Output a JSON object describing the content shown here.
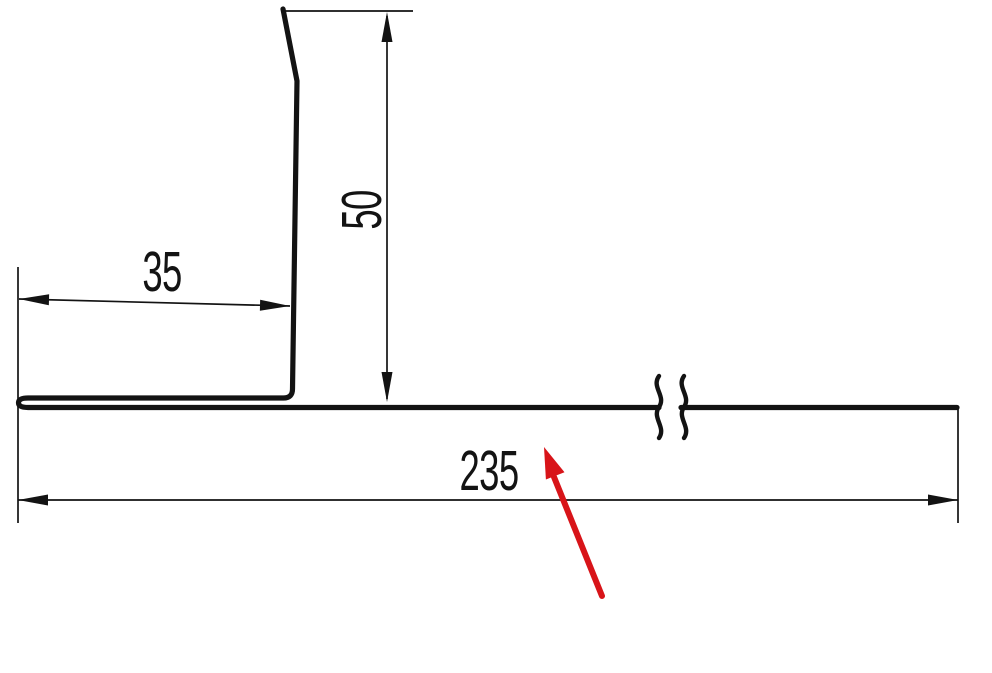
{
  "drawing": {
    "kind": "profile-cross-section-technical-drawing",
    "dimensions": {
      "hem_width": "35",
      "leg_height": "50",
      "base_length": "235"
    },
    "colors": {
      "line": "#131313",
      "accent": "#d81419",
      "background": "#ffffff"
    }
  }
}
